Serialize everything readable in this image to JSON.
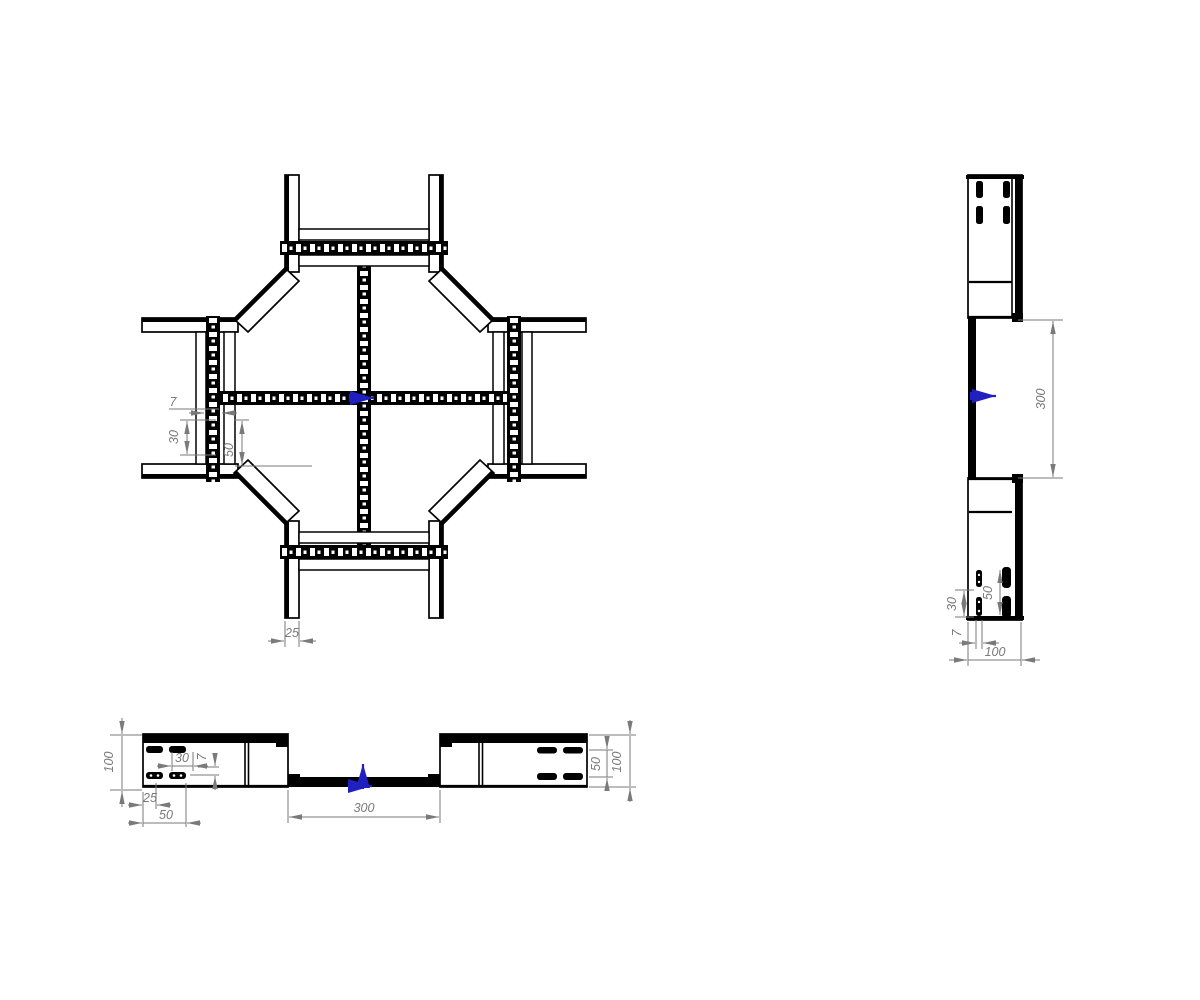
{
  "canvas": {
    "width": 1200,
    "height": 1000,
    "background": "#ffffff"
  },
  "colors": {
    "line": "#000000",
    "dimension": "#7a7a7a",
    "accent_blue": "#2020c0"
  },
  "views": {
    "plan": {
      "label": "plan-view-cross-piece",
      "dims": {
        "web_7": "7",
        "pitch_30": "30",
        "pitch_50": "50",
        "rail_width_25": "25"
      }
    },
    "side": {
      "label": "side-view",
      "dims": {
        "opening_300": "300",
        "slot_pitch_50": "50",
        "slot_pitch_30": "30",
        "slot_gap_7": "7",
        "depth_100": "100"
      }
    },
    "front": {
      "label": "front-view",
      "dims": {
        "height_left_100": "100",
        "slot_pitch_30": "30",
        "slot_gap_7": "7",
        "offset_25": "25",
        "offset_50": "50",
        "opening_300": "300",
        "slot_pitch_right_50": "50",
        "height_right_100": "100"
      }
    }
  }
}
